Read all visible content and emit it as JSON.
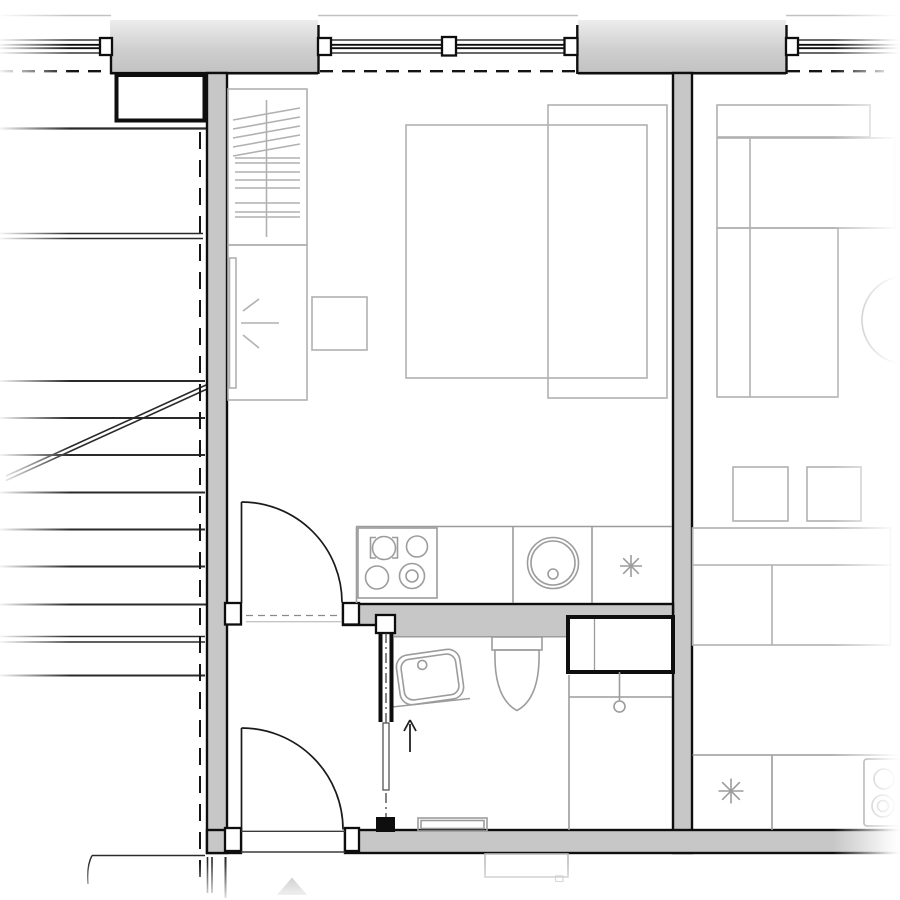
{
  "plan": {
    "kind": "Architectural floor plan — studio apartment with stairwell and neighboring unit",
    "text_on_drawing": "none",
    "areas": {
      "stairwell": {
        "elements": [
          "stair-treads",
          "stair-stringer-diagonal",
          "dashed-projection-line",
          "landing-lines"
        ]
      },
      "studio_unit": {
        "main_room": [
          "wardrobe-with-hanging-rail",
          "dressing-table-with-mirror",
          "mirror-light-rays-symbol",
          "side-table",
          "double-bed-with-duvet",
          "window-with-center-mullion"
        ],
        "kitchenette": [
          "counter-run",
          "cooktop-4-burners",
          "round-sink-with-drain",
          "appliance-asterisk-symbol"
        ],
        "entry_hall": [
          "swing-door-to-room",
          "entry-swing-door",
          "door-jambs"
        ],
        "bathroom": [
          "pocket-sliding-door",
          "washbasin-with-faucet",
          "toilet",
          "shower-area-with-drain",
          "service-shaft",
          "floor-convector-bench",
          "entry-direction-arrow"
        ]
      },
      "neighbor_unit": {
        "elements": [
          "bed-with-pillow",
          "round-side-table-arc",
          "two-stools",
          "long-table",
          "kitchen-counter",
          "cooktop-2-burners",
          "appliance-asterisk-symbol",
          "window"
        ]
      },
      "building": [
        "north-facade-wall",
        "windows-triple",
        "dashed-line-of-storey-above",
        "west-wall",
        "party-wall",
        "south-wall-with-entry-opening",
        "top-left-duct-shaft",
        "site-boundary-lines",
        "grey-triangle-marker",
        "below-wall-convector-outline"
      ]
    },
    "symbols": {
      "asterisk": "appliance / boiler position marker",
      "arrow-up": "entrance direction into bathroom zone",
      "starburst-rays": "light at dressing mirror",
      "dashed-lines": "elements above cut plane"
    }
  },
  "colors": {
    "background": "#ffffff",
    "wall-fill": "#c7c7c7",
    "wall-fill-light": "#ececec",
    "wall-edge": "#0e0e0e",
    "furniture-line": "#b1b1b1",
    "fixture-line": "#9c9c9c",
    "door-line": "#1a1a1a",
    "stair-line": "#2a2a2a"
  }
}
